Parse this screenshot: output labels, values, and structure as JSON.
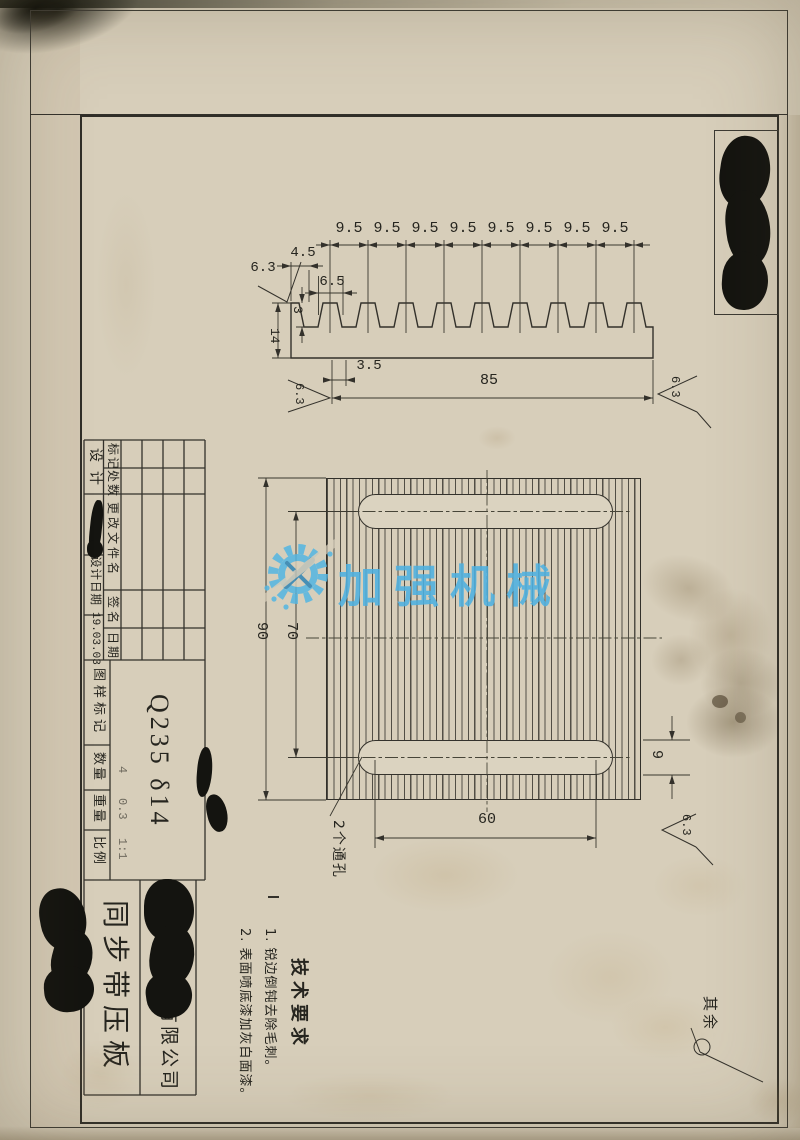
{
  "top_view": {
    "pitch_dims": [
      "9.5",
      "9.5",
      "9.5",
      "9.5",
      "9.5",
      "9.5",
      "9.5",
      "9.5"
    ],
    "dim_width_top": "4.5",
    "dim_tooth_width": "6.5",
    "dim_tooth_depth": "3",
    "dim_height": "14",
    "dim_root_width": "3.5",
    "dim_length": "85",
    "finish_top": "6.3",
    "finish_bottom_left": "6.3",
    "finish_right": "6.3"
  },
  "plan_view": {
    "dim_height": "90",
    "dim_slot_spacing": "70",
    "dim_slot_length": "60",
    "dim_slot_width": "9",
    "finish": "6.3",
    "holes_note": "2个通孔"
  },
  "tech_requirements": {
    "title": "技术要求",
    "item1": "1. 锐边倒钝去除毛刺。",
    "item2": "2. 表面喷底漆加灰白面漆。"
  },
  "remainder_note": "其余",
  "title_block": {
    "rev_headers": {
      "mark": "标记",
      "count": "处数",
      "file": "更改文件名",
      "sign": "签名",
      "date": "日期"
    },
    "design_label": "设计",
    "design_date_label": "设计日期",
    "design_date": "19.03.03",
    "drawing_mark_label": "图样标记",
    "qty_label": "数量",
    "qty_value": "4",
    "weight_label": "重量",
    "weight_value": "0.3",
    "scale_label": "比例",
    "scale_value": "1:1",
    "material": "Q235 δ14",
    "company_suffix": "有限公司",
    "part_name": "同步带压板"
  },
  "watermark": {
    "text": "加强机械"
  },
  "colors": {
    "paper": "#d7ceba",
    "line": "#33312b",
    "watermark_blue": "#58b9e4"
  }
}
